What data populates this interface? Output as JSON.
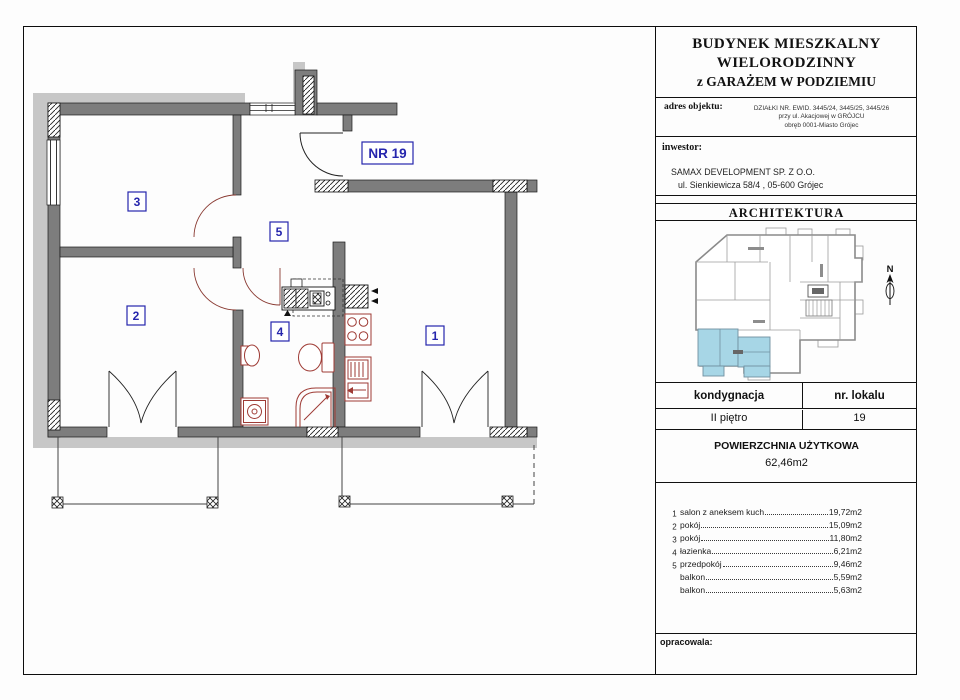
{
  "plan": {
    "unit_label": "NR 19",
    "rooms": {
      "r1": "1",
      "r2": "2",
      "r3": "3",
      "r4": "4",
      "r5": "5"
    }
  },
  "title_block": {
    "title_lines": [
      "BUDYNEK MIESZKALNY",
      "WIELORODZINNY",
      "z GARAŻEM  W PODZIEMIU"
    ],
    "address_label": "adres objektu:",
    "address_lines": [
      "DZIAŁKI NR. EWID. 3445/24, 3445/25, 3445/26",
      "przy ul. Akacjowej w GRÓJCU",
      "obręb 0001-Miasto Grójec"
    ],
    "investor_label": "inwestor:",
    "investor_lines": [
      "SAMAX DEVELOPMENT SP. Z O.O.",
      "ul. Sienkiewicza 58/4 , 05-600 Grójec"
    ],
    "architecture_header": "ARCHITEKTURA",
    "north_label": "N",
    "floor": {
      "label": "kondygnacja",
      "value": "II piętro"
    },
    "unit": {
      "label": "nr. lokalu",
      "value": "19"
    },
    "area": {
      "label": "POWIERZCHNIA UŻYTKOWA",
      "value": "62,46m2"
    },
    "room_list": [
      {
        "no": "1",
        "name": "salon z aneksem kuch",
        "area": "19,72m2"
      },
      {
        "no": "2",
        "name": "pokój",
        "area": "15,09m2"
      },
      {
        "no": "3",
        "name": "pokój",
        "area": "11,80m2"
      },
      {
        "no": "4",
        "name": "łazienka",
        "area": "6,21m2"
      },
      {
        "no": "5",
        "name": "przedpokój",
        "area": "9,46m2"
      },
      {
        "no": "",
        "name": "balkon",
        "area": "5,59m2"
      },
      {
        "no": "",
        "name": "balkon",
        "area": "5,63m2"
      }
    ],
    "prepared_label": "opracowala:"
  },
  "colors": {
    "wall": "#7d7d7d",
    "insulation": "#c7c7c7",
    "fixture_red": "#9e3a34",
    "label_blue": "#2626ad",
    "highlight_blue": "#a7d6e6"
  }
}
